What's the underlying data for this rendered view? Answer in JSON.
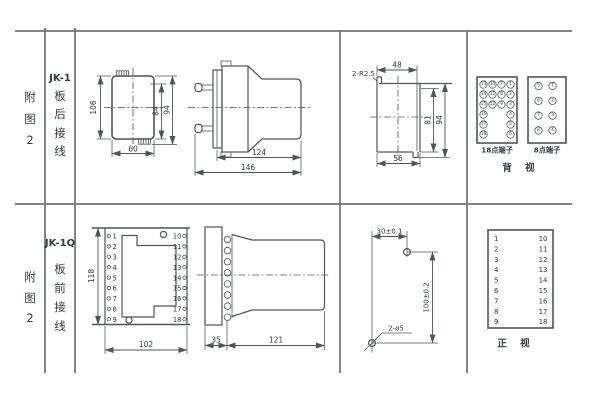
{
  "colors": {
    "bg": "#ffffff",
    "frame": "#6f7276",
    "draw": "#4f545b",
    "text": "#333a45"
  },
  "sidebar": {
    "rows": [
      {
        "fig": [
          "附",
          "图",
          "2"
        ],
        "model": "JK-1",
        "wiring": [
          "板",
          "后",
          "接",
          "线"
        ]
      },
      {
        "fig": [
          "附",
          "图",
          "2"
        ],
        "model": "JK-1Q",
        "wiring": [
          "板",
          "前",
          "接",
          "线"
        ]
      }
    ]
  },
  "row1": {
    "rear": {
      "h": "106",
      "inner": "84",
      "outer": "94",
      "w": "60"
    },
    "side": {
      "body": "124",
      "total": "146"
    },
    "cutout": {
      "r": "2-R2.5",
      "top": "48",
      "inner": "81",
      "outer": "94",
      "bottom": "56"
    },
    "t18": {
      "label": "18点端子",
      "col1": [
        "13",
        "14",
        "15",
        "16",
        "17",
        "18"
      ],
      "col2": [
        "10",
        "11",
        "12"
      ],
      "col3": [
        "7",
        "8",
        "9"
      ],
      "col4": [
        "1",
        "2",
        "3",
        "4",
        "5",
        "6"
      ]
    },
    "t8": {
      "label": "8点端子",
      "left": [
        "5",
        "6",
        "7",
        "8"
      ],
      "right": [
        "1",
        "2",
        "3",
        "4"
      ]
    },
    "view": "背 视"
  },
  "row2": {
    "front": {
      "h": "118",
      "w": "102",
      "left": [
        "1",
        "2",
        "3",
        "4",
        "5",
        "6",
        "7",
        "8",
        "9"
      ],
      "right": [
        "10",
        "11",
        "12",
        "13",
        "14",
        "15",
        "16",
        "17",
        "18"
      ]
    },
    "side": {
      "flange": "35",
      "body": "121"
    },
    "drill": {
      "w": "30±0.1",
      "h": "100±0.2",
      "holes": "2-ø5"
    },
    "table": {
      "left": [
        "1",
        "2",
        "3",
        "4",
        "5",
        "6",
        "7",
        "8",
        "9"
      ],
      "right": [
        "10",
        "11",
        "12",
        "13",
        "14",
        "15",
        "16",
        "17",
        "18"
      ],
      "view": "正 视"
    }
  }
}
